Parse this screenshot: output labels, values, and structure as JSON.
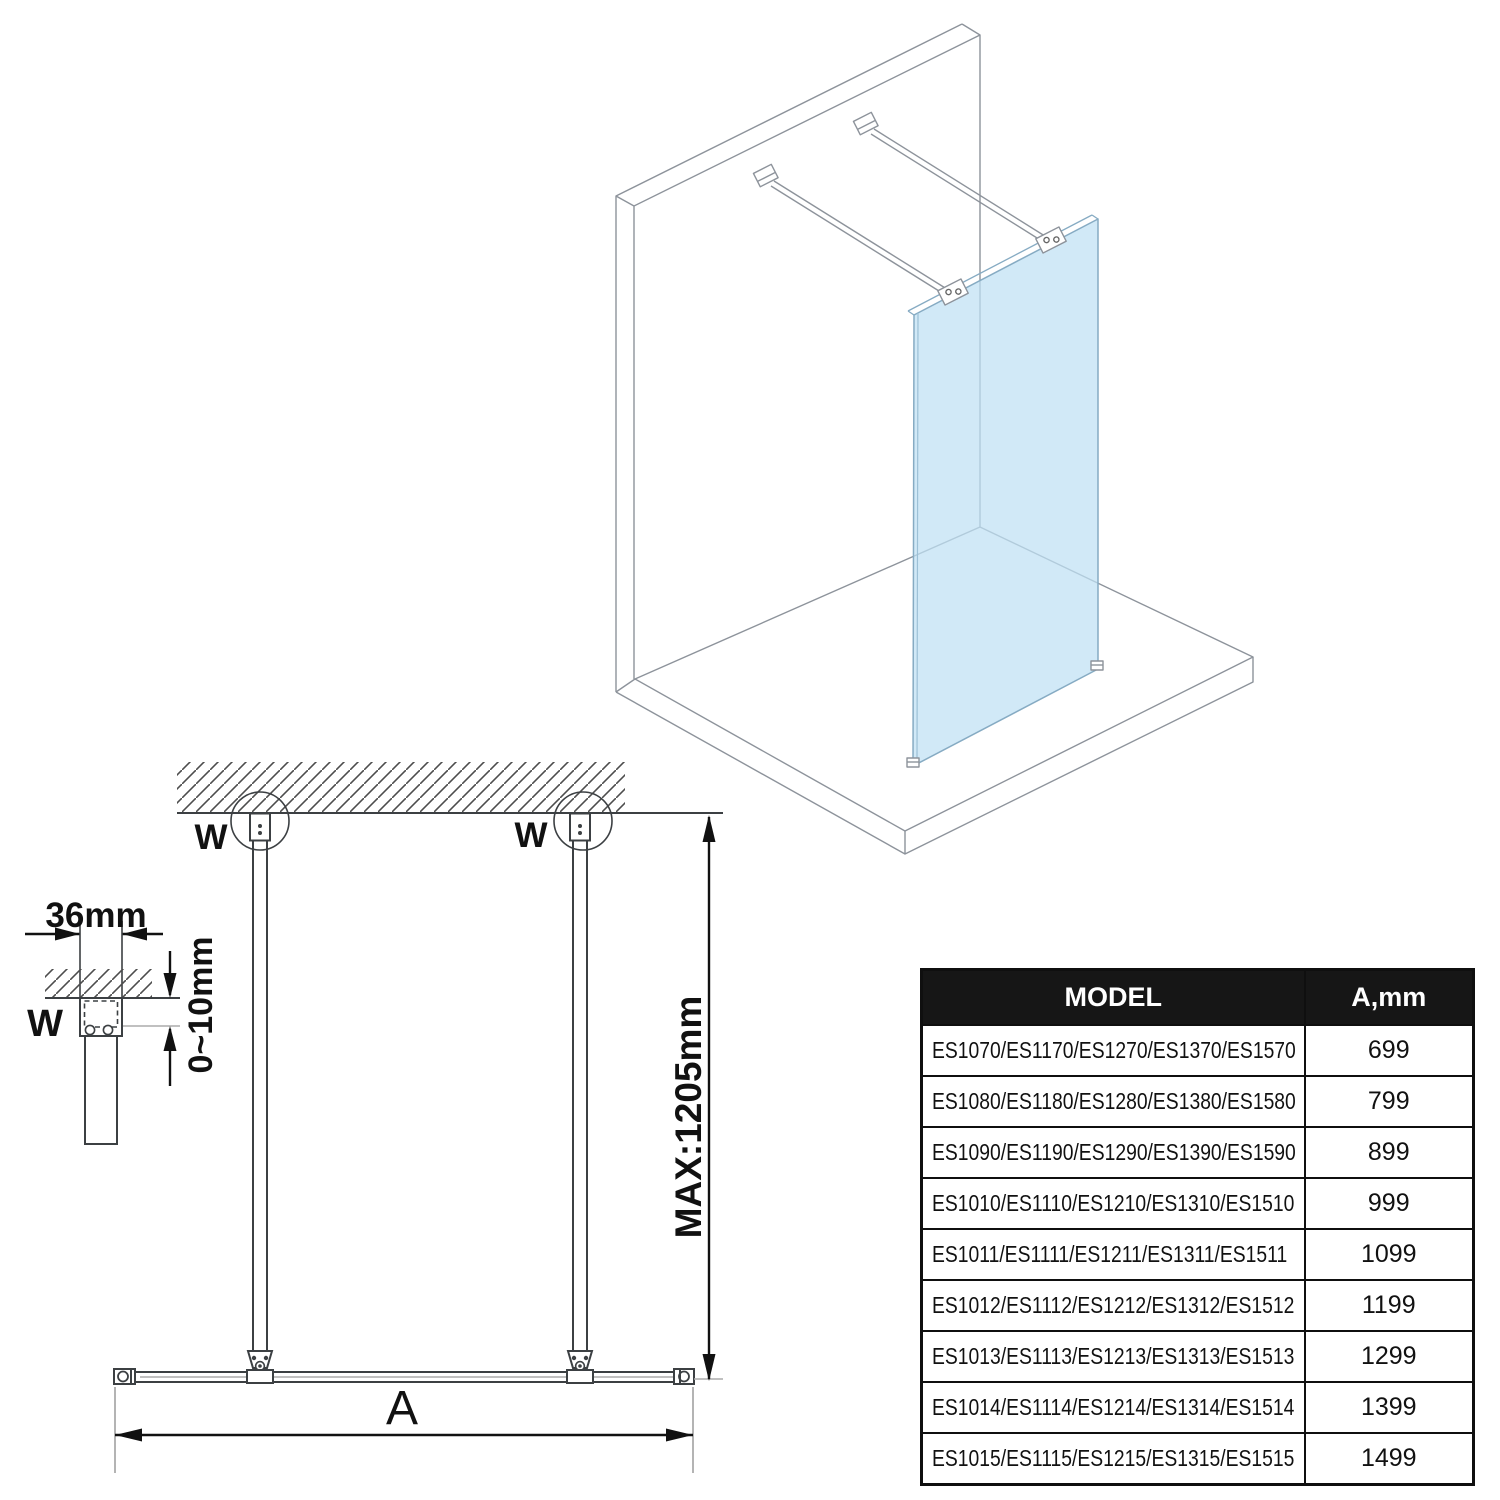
{
  "iso_view": {
    "glass_color": "#bfe0f4",
    "glass_edge_color": "#86abc3",
    "line_color": "#8d939b"
  },
  "plan_view": {
    "w_left": "W",
    "w_right": "W",
    "max_label": "MAX:1205mm",
    "a_label": "A"
  },
  "detail_view": {
    "width_label": "36mm",
    "gap_label": "0~10mm",
    "w_label": "W"
  },
  "table": {
    "headers": [
      "MODEL",
      "A,mm"
    ],
    "header_bg": "#161616",
    "header_fg": "#ffffff",
    "rows": [
      {
        "model": "ES1070/ES1170/ES1270/ES1370/ES1570",
        "a_mm": "699"
      },
      {
        "model": "ES1080/ES1180/ES1280/ES1380/ES1580",
        "a_mm": "799"
      },
      {
        "model": "ES1090/ES1190/ES1290/ES1390/ES1590",
        "a_mm": "899"
      },
      {
        "model": "ES1010/ES1110/ES1210/ES1310/ES1510",
        "a_mm": "999"
      },
      {
        "model": "ES1011/ES1111/ES1211/ES1311/ES1511",
        "a_mm": "1099"
      },
      {
        "model": "ES1012/ES1112/ES1212/ES1312/ES1512",
        "a_mm": "1199"
      },
      {
        "model": "ES1013/ES1113/ES1213/ES1313/ES1513",
        "a_mm": "1299"
      },
      {
        "model": "ES1014/ES1114/ES1214/ES1314/ES1514",
        "a_mm": "1399"
      },
      {
        "model": "ES1015/ES1115/ES1215/ES1315/ES1515",
        "a_mm": "1499"
      }
    ]
  }
}
